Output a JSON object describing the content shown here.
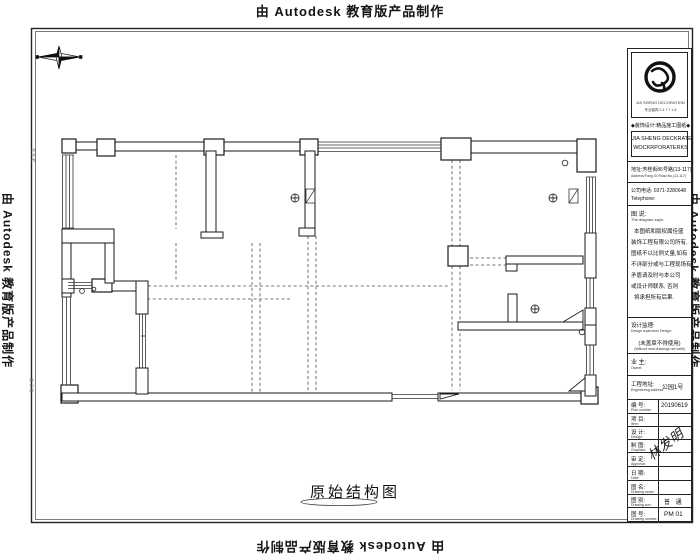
{
  "watermark": {
    "text": "由 Autodesk 教育版产品制作"
  },
  "plan": {
    "title": "原始结构图"
  },
  "title_block": {
    "tagline": "◆装饰设计:精品施工图纸◆",
    "logo": {
      "caption": "JIA SHENG DECORATION",
      "sub": "专业装饰  2 4 7 7 1 A"
    },
    "company_line1": "JIA SHENG DECKRATE",
    "company_line2": "WOCKRPORATERKS",
    "address_cn": "地址:芳桂街86号路(13-117)",
    "address_en": "Address:Fang Gi Road No.(13-117)",
    "phone_cn": "公司电话: 0371-2280648",
    "phone_en": "Telephone:",
    "notes": {
      "title_cn": "图 说:",
      "title_en": "The diagram says:",
      "lines": [
        "本图纸和版权属佳盛",
        "装饰工程有限公司所有,",
        "图纸不以比例丈量,如有",
        "不详部分或与工程现场有",
        "矛盾请及时与本公司",
        "或设计师联系, 否则",
        "将承担所有后果."
      ]
    },
    "supervision": {
      "label_cn": "设计监理:",
      "label_en": "Design supervisor Design:",
      "seal_cn": "(未盖章不得使用)",
      "seal_en": "(Without seal drawings not valid)"
    },
    "owner": {
      "label_cn": "业 主:",
      "label_en": "Owner:"
    },
    "site": {
      "label_cn": "工程地址:",
      "label_en": "Engineering address:",
      "value": "公园1号"
    },
    "rows": [
      {
        "label": "编 号:",
        "en": "Plan number:",
        "value": "20190619"
      },
      {
        "label": "项 目:",
        "en": "Item:",
        "value": ""
      },
      {
        "label": "设 计:",
        "en": "Design:",
        "value": ""
      },
      {
        "label": "制 图:",
        "en": "Graphics:",
        "value": ""
      },
      {
        "label": "审 定:",
        "en": "Approval:",
        "value": ""
      },
      {
        "label": "日 期:",
        "en": "Date:",
        "value": ""
      },
      {
        "label": "图 名:",
        "en": "Drawing name:",
        "value": ""
      },
      {
        "label": "图 别:",
        "en": "Drawing sort:",
        "value": "普 通"
      },
      {
        "label": "图 号:",
        "en": "Drawing number:",
        "value": "PM 01"
      }
    ],
    "signature": "林发明"
  },
  "margin_notes": {
    "left_top": "会 签 栏",
    "left_bottom": "装 订 线"
  }
}
